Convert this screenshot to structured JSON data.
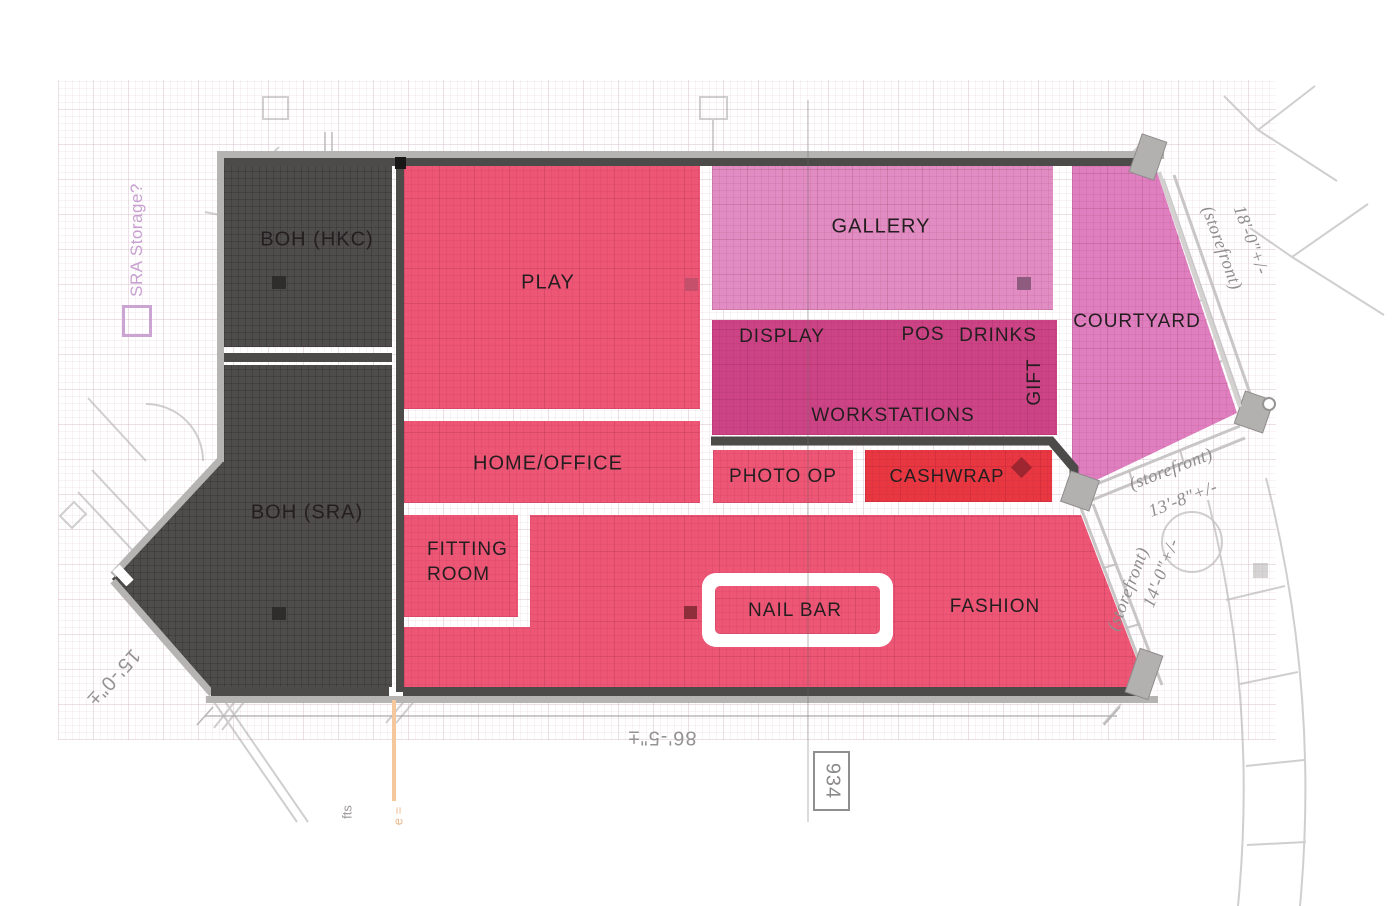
{
  "plan": {
    "zones": {
      "boh_hkc": {
        "label": "BOH (HKC)"
      },
      "boh_sra": {
        "label": "BOH (SRA)"
      },
      "play": {
        "label": "PLAY"
      },
      "gallery": {
        "label": "GALLERY"
      },
      "courtyard": {
        "label": "COURTYARD"
      },
      "display": {
        "label": "DISPLAY"
      },
      "pos": {
        "label": "POS"
      },
      "drinks": {
        "label": "DRINKS"
      },
      "gift": {
        "label": "GIFT"
      },
      "workstations": {
        "label": "WORKSTATIONS"
      },
      "home_office": {
        "label": "HOME/OFFICE"
      },
      "photo_op": {
        "label": "PHOTO OP"
      },
      "cashwrap": {
        "label": "CASHWRAP"
      },
      "fitting_room": {
        "label": "FITTING ROOM"
      },
      "nail_bar": {
        "label": "NAIL BAR"
      },
      "fashion": {
        "label": "FASHION"
      }
    },
    "annotations": {
      "sra_storage": "SRA Storage?",
      "storefront_top": {
        "label": "(storefront)",
        "dim": "18'-0\"+/-"
      },
      "storefront_mid": {
        "label": "(storefront)",
        "dim": "13'-8\"+/-"
      },
      "storefront_low": {
        "label": "(storefront)",
        "dim": "14'-0\"+/-"
      },
      "dim_bottom": "86'-5\"±",
      "dim_left": "15'-0\"±",
      "door_number": "934",
      "note_fts": "fts",
      "note_orange": "e ="
    },
    "colors": {
      "boh": "#4f4c4c",
      "retail_pink": "#ee5676",
      "gallery": "#e18cc2",
      "courtyard": "#df7fc0",
      "workstations": "#cc4486",
      "cashwrap": "#e83741",
      "wall_light": "#b6b3b3",
      "wall_dark": "#4d4a4a",
      "note_purple": "#c79fd0",
      "note_orange": "#edb88c"
    }
  }
}
